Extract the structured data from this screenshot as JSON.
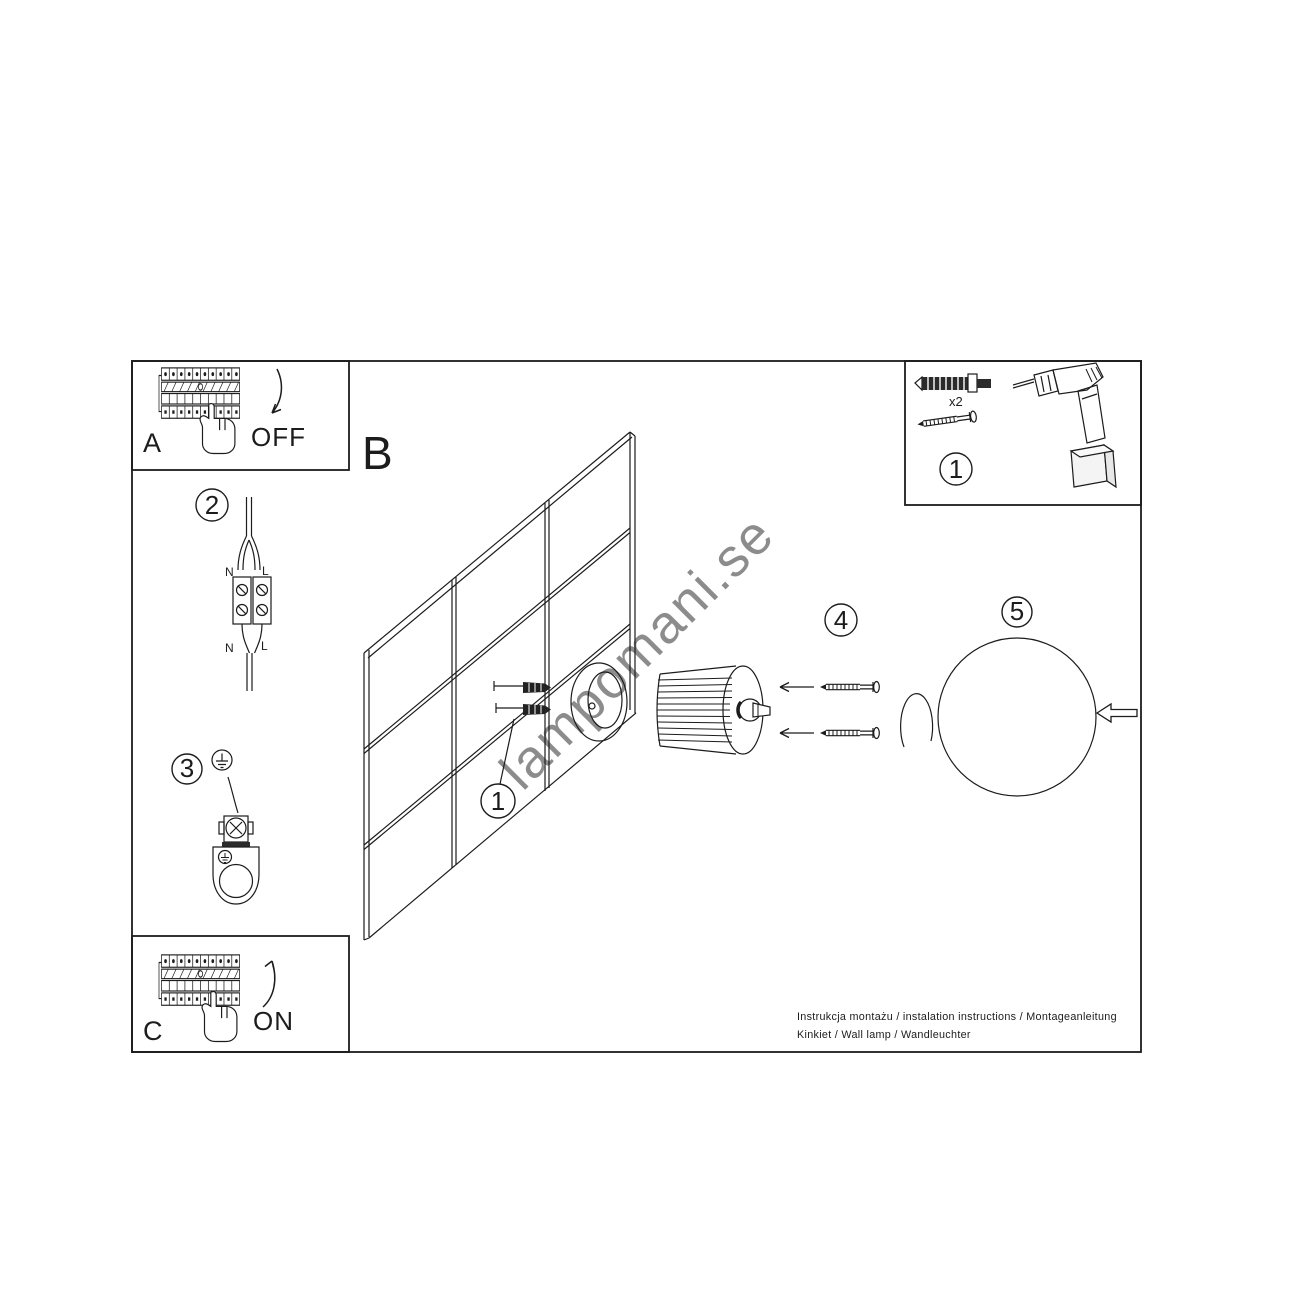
{
  "page": {
    "background": "#ffffff",
    "line_color": "#1c1c1c"
  },
  "panel_a": {
    "letter": "A",
    "action": "OFF"
  },
  "panel_c": {
    "letter": "C",
    "action": "ON"
  },
  "main": {
    "letter": "B"
  },
  "kit": {
    "badge": "1",
    "quantity": "x2"
  },
  "wiring": {
    "badge": "2",
    "top_left": "N",
    "top_right": "L",
    "bottom_left": "N",
    "bottom_right": "L"
  },
  "grounding": {
    "badge": "3"
  },
  "anchors": {
    "badge": "1"
  },
  "screws": {
    "badge": "4"
  },
  "globe": {
    "badge": "5"
  },
  "footer": {
    "line1": "Instrukcja montażu / instalation instructions / Montageanleitung",
    "line2": "Kinkiet / Wall lamp / Wandleuchter"
  },
  "watermark": {
    "text": "lampomani.se",
    "color": "#8a8a8a"
  }
}
